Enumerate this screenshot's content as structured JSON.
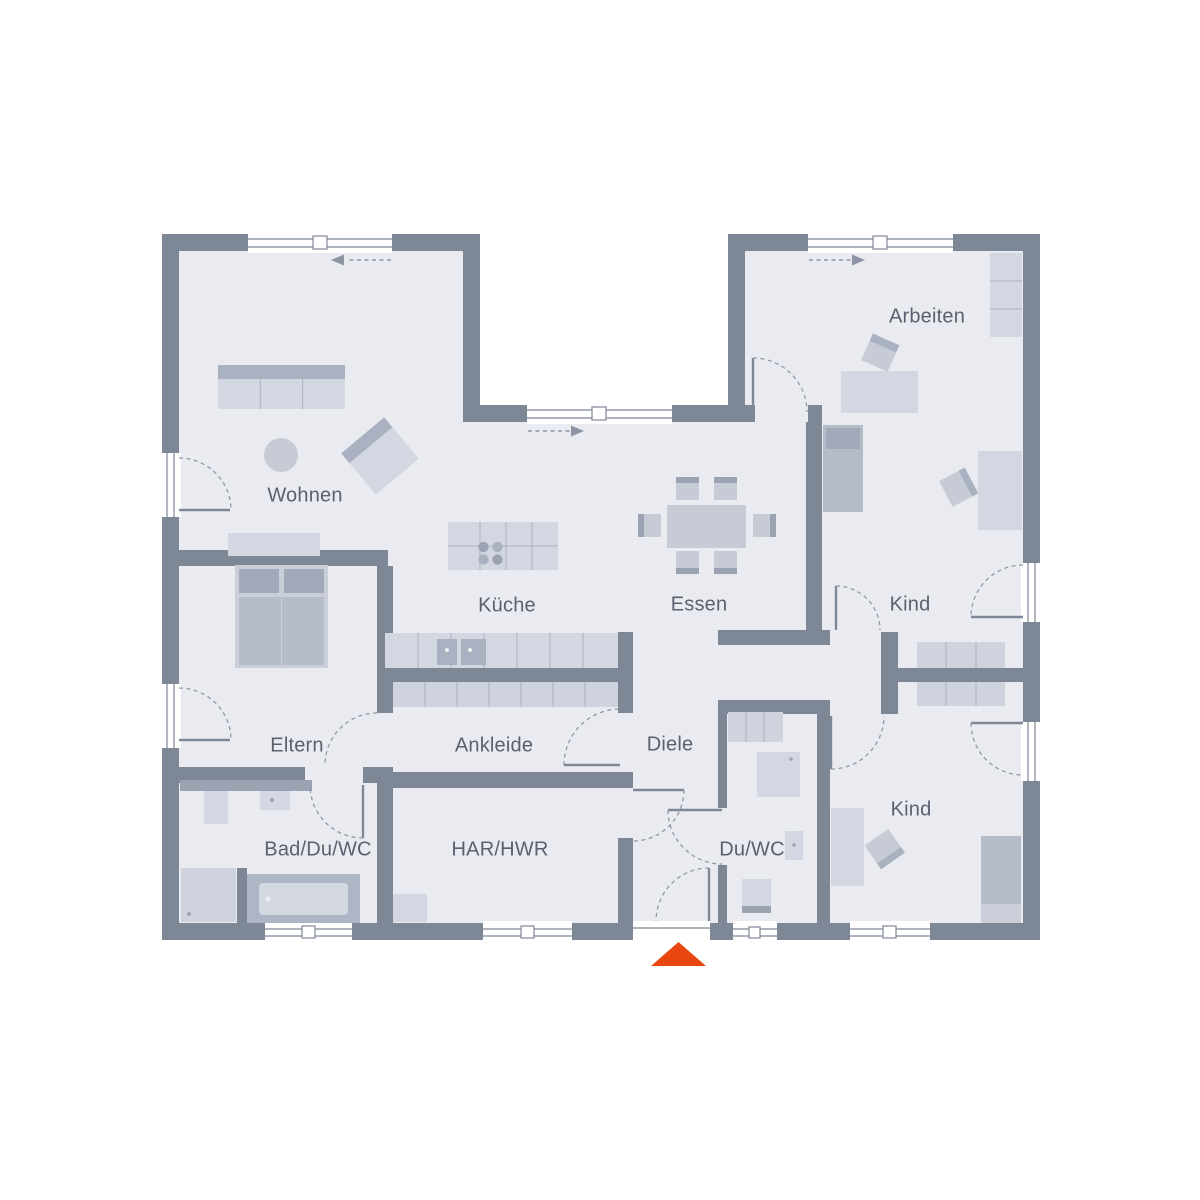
{
  "plan_title": "floor-plan",
  "rooms": {
    "wohnen": {
      "label": "Wohnen"
    },
    "kueche": {
      "label": "Küche"
    },
    "essen": {
      "label": "Essen"
    },
    "arbeiten": {
      "label": "Arbeiten"
    },
    "kind1": {
      "label": "Kind"
    },
    "kind2": {
      "label": "Kind"
    },
    "eltern": {
      "label": "Eltern"
    },
    "ankleide": {
      "label": "Ankleide"
    },
    "diele": {
      "label": "Diele"
    },
    "bad": {
      "label": "Bad/Du/WC"
    },
    "har": {
      "label": "HAR/HWR"
    },
    "duwc": {
      "label": "Du/WC"
    }
  },
  "colors": {
    "wall": "#7e8796",
    "floor": "#e9ebf1",
    "accent": "#e8480f",
    "text": "#59616f",
    "furniture_light": "#d3d7e1",
    "furniture_mid": "#c6cbd6",
    "furniture_dark": "#aab1c0",
    "furniture_deep": "#9ba3b2",
    "furniture_row": "#ced3dd"
  }
}
